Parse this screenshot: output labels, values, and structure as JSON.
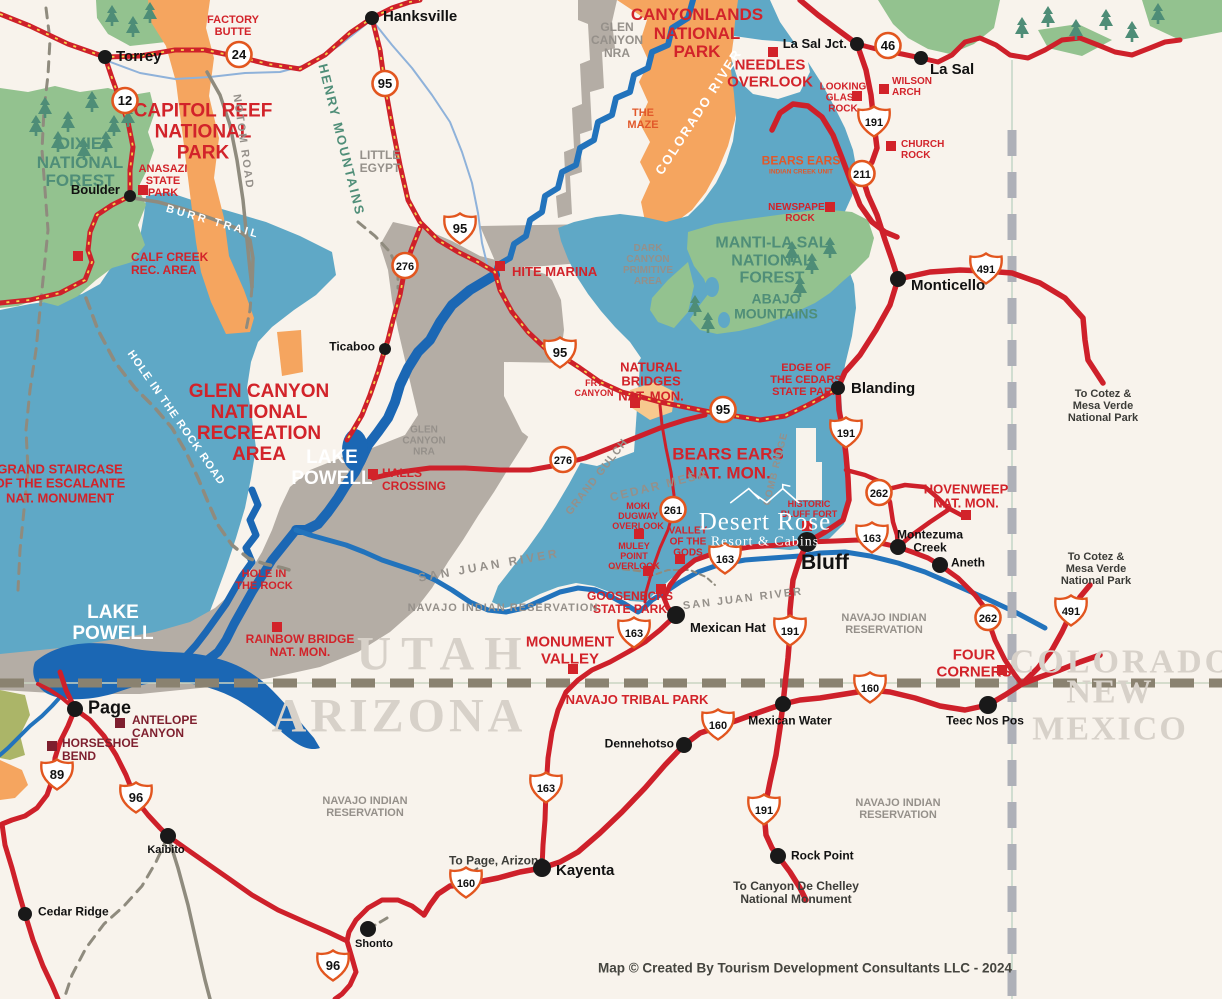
{
  "caption": "Map © Created By Tourism Development Consultants LLC - 2024",
  "desert_rose": {
    "name": "Desert Rose",
    "sub": "Resort & Cabins"
  },
  "colors": {
    "background": "#F8F3EC",
    "road_red": "#CE202A",
    "road_dash_yellow": "#F6D44C",
    "region_blue": "#5FA8C6",
    "region_gray": "#B4ADA5",
    "region_orange": "#F5A55F",
    "region_green": "#93C28F",
    "water_blue": "#1B67B4",
    "river_blue": "#2273BC",
    "label_red": "#D2232A",
    "label_dark_red": "#7E1F2E",
    "label_green": "#4F8E78",
    "label_gray": "#95908A",
    "state_name_gray": "#D7D1C9",
    "border_dash_tan": "#8A8270",
    "border_dash_gray": "#AEB0B8",
    "shield_border": "#E2561F"
  },
  "towns": [
    {
      "name": "Torrey",
      "dot": {
        "x": 105,
        "y": 57,
        "r": 7
      },
      "label": {
        "x": 116,
        "y": 57,
        "anchor": "l",
        "size": 15
      }
    },
    {
      "name": "Hanksville",
      "dot": {
        "x": 372,
        "y": 18,
        "r": 7
      },
      "label": {
        "x": 383,
        "y": 17,
        "anchor": "l",
        "size": 15
      }
    },
    {
      "name": "Boulder",
      "dot": {
        "x": 130,
        "y": 196,
        "r": 6
      },
      "label": {
        "x": 120,
        "y": 190,
        "anchor": "r",
        "size": 13
      }
    },
    {
      "name": "Ticaboo",
      "dot": {
        "x": 385,
        "y": 349,
        "r": 6
      },
      "label": {
        "x": 375,
        "y": 347,
        "anchor": "r",
        "size": 12
      }
    },
    {
      "name": "La Sal Jct.",
      "dot": {
        "x": 857,
        "y": 44,
        "r": 7
      },
      "label": {
        "x": 847,
        "y": 44,
        "anchor": "r",
        "size": 13
      }
    },
    {
      "name": "La Sal",
      "dot": {
        "x": 921,
        "y": 58,
        "r": 7
      },
      "label": {
        "x": 930,
        "y": 70,
        "anchor": "l",
        "size": 15
      }
    },
    {
      "name": "Monticello",
      "dot": {
        "x": 898,
        "y": 279,
        "r": 8
      },
      "label": {
        "x": 911,
        "y": 286,
        "anchor": "l",
        "size": 15
      }
    },
    {
      "name": "Blanding",
      "dot": {
        "x": 838,
        "y": 388,
        "r": 7
      },
      "label": {
        "x": 851,
        "y": 389,
        "anchor": "l",
        "size": 15
      }
    },
    {
      "name": "Bluff",
      "dot": {
        "x": 807,
        "y": 542,
        "r": 10
      },
      "label": {
        "x": 801,
        "y": 563,
        "anchor": "l",
        "size": 21
      }
    },
    {
      "name": "Mexican Hat",
      "dot": {
        "x": 676,
        "y": 615,
        "r": 9
      },
      "label": {
        "x": 690,
        "y": 628,
        "anchor": "l",
        "size": 13
      }
    },
    {
      "name": "Montezuma\nCreek",
      "dot": {
        "x": 898,
        "y": 547,
        "r": 8
      },
      "label": {
        "x": 930,
        "y": 541,
        "anchor": "c",
        "size": 12
      }
    },
    {
      "name": "Aneth",
      "dot": {
        "x": 940,
        "y": 565,
        "r": 8
      },
      "label": {
        "x": 951,
        "y": 563,
        "anchor": "l",
        "size": 12
      }
    },
    {
      "name": "Teec Nos Pos",
      "dot": {
        "x": 988,
        "y": 705,
        "r": 9
      },
      "label": {
        "x": 985,
        "y": 721,
        "anchor": "c",
        "size": 12
      }
    },
    {
      "name": "Mexican Water",
      "dot": {
        "x": 783,
        "y": 704,
        "r": 8
      },
      "label": {
        "x": 790,
        "y": 721,
        "anchor": "c",
        "size": 12
      }
    },
    {
      "name": "Dennehotso",
      "dot": {
        "x": 684,
        "y": 745,
        "r": 8
      },
      "label": {
        "x": 674,
        "y": 744,
        "anchor": "r",
        "size": 12
      }
    },
    {
      "name": "Rock Point",
      "dot": {
        "x": 778,
        "y": 856,
        "r": 8
      },
      "label": {
        "x": 791,
        "y": 856,
        "anchor": "l",
        "size": 12
      }
    },
    {
      "name": "Kayenta",
      "dot": {
        "x": 542,
        "y": 868,
        "r": 9
      },
      "label": {
        "x": 556,
        "y": 871,
        "anchor": "l",
        "size": 15
      }
    },
    {
      "name": "Shonto",
      "dot": {
        "x": 368,
        "y": 929,
        "r": 8
      },
      "label": {
        "x": 374,
        "y": 945,
        "anchor": "c",
        "size": 11
      }
    },
    {
      "name": "Kaibito",
      "dot": {
        "x": 168,
        "y": 836,
        "r": 8
      },
      "label": {
        "x": 166,
        "y": 851,
        "anchor": "c",
        "size": 11
      }
    },
    {
      "name": "Cedar Ridge",
      "dot": {
        "x": 25,
        "y": 914,
        "r": 7
      },
      "label": {
        "x": 38,
        "y": 912,
        "anchor": "l",
        "size": 12
      }
    },
    {
      "name": "Page",
      "dot": {
        "x": 75,
        "y": 709,
        "r": 8
      },
      "label": {
        "x": 88,
        "y": 708,
        "anchor": "l",
        "size": 18
      }
    }
  ],
  "poi_squares": [
    {
      "name": "anasazi-state-park",
      "x": 143,
      "y": 190,
      "color": "#D2232A"
    },
    {
      "name": "calf-creek",
      "x": 78,
      "y": 256,
      "color": "#D2232A"
    },
    {
      "name": "hite-marina",
      "x": 500,
      "y": 266,
      "color": "#D2232A"
    },
    {
      "name": "needles-overlook",
      "x": 773,
      "y": 52,
      "color": "#D2232A"
    },
    {
      "name": "wilson-arch",
      "x": 884,
      "y": 89,
      "color": "#D2232A"
    },
    {
      "name": "looking-glass-rock",
      "x": 857,
      "y": 96,
      "color": "#D2232A"
    },
    {
      "name": "church-rock",
      "x": 891,
      "y": 146,
      "color": "#D2232A"
    },
    {
      "name": "newspaper-rock",
      "x": 830,
      "y": 207,
      "color": "#D2232A"
    },
    {
      "name": "natural-bridges",
      "x": 635,
      "y": 403,
      "color": "#D2232A"
    },
    {
      "name": "hovenweep",
      "x": 966,
      "y": 515,
      "color": "#D2232A"
    },
    {
      "name": "halls-crossing",
      "x": 373,
      "y": 474,
      "color": "#D2232A"
    },
    {
      "name": "moki-dugway",
      "x": 639,
      "y": 534,
      "color": "#D2232A"
    },
    {
      "name": "muley-point",
      "x": 648,
      "y": 571,
      "color": "#D2232A"
    },
    {
      "name": "valley-of-the-gods",
      "x": 680,
      "y": 559,
      "color": "#D2232A"
    },
    {
      "name": "goosenecks",
      "x": 661,
      "y": 589,
      "color": "#D2232A"
    },
    {
      "name": "monument-valley",
      "x": 573,
      "y": 669,
      "color": "#D2232A"
    },
    {
      "name": "four-corners",
      "x": 1002,
      "y": 670,
      "color": "#D2232A"
    },
    {
      "name": "rainbow-bridge",
      "x": 277,
      "y": 627,
      "color": "#D2232A"
    },
    {
      "name": "historic-bluff-fort",
      "x": 807,
      "y": 526,
      "color": "#D2232A"
    },
    {
      "name": "antelope-canyon",
      "x": 120,
      "y": 723,
      "color": "#7E1F2E"
    },
    {
      "name": "horseshoe-bend",
      "x": 52,
      "y": 746,
      "color": "#7E1F2E"
    }
  ],
  "shields": [
    {
      "n": "24",
      "type": "circle",
      "x": 239,
      "y": 57
    },
    {
      "n": "12",
      "type": "circle",
      "x": 125,
      "y": 103
    },
    {
      "n": "95",
      "type": "circle",
      "x": 385,
      "y": 86
    },
    {
      "n": "95",
      "type": "shield",
      "x": 460,
      "y": 231
    },
    {
      "n": "276",
      "type": "circle",
      "x": 405,
      "y": 268
    },
    {
      "n": "95",
      "type": "shield",
      "x": 560,
      "y": 355
    },
    {
      "n": "95",
      "type": "circle",
      "x": 723,
      "y": 412
    },
    {
      "n": "276",
      "type": "circle",
      "x": 563,
      "y": 462
    },
    {
      "n": "261",
      "type": "circle",
      "x": 673,
      "y": 512
    },
    {
      "n": "46",
      "type": "circle",
      "x": 888,
      "y": 48
    },
    {
      "n": "191",
      "type": "shield",
      "x": 874,
      "y": 124
    },
    {
      "n": "211",
      "type": "circle",
      "x": 862,
      "y": 176
    },
    {
      "n": "491",
      "type": "shield",
      "x": 986,
      "y": 271
    },
    {
      "n": "191",
      "type": "shield",
      "x": 846,
      "y": 435
    },
    {
      "n": "262",
      "type": "circle",
      "x": 879,
      "y": 495
    },
    {
      "n": "163",
      "type": "shield",
      "x": 872,
      "y": 540
    },
    {
      "n": "163",
      "type": "shield",
      "x": 725,
      "y": 561
    },
    {
      "n": "163",
      "type": "shield",
      "x": 634,
      "y": 635
    },
    {
      "n": "191",
      "type": "shield",
      "x": 790,
      "y": 633
    },
    {
      "n": "262",
      "type": "circle",
      "x": 988,
      "y": 620
    },
    {
      "n": "491",
      "type": "shield",
      "x": 1071,
      "y": 613
    },
    {
      "n": "160",
      "type": "shield",
      "x": 870,
      "y": 690
    },
    {
      "n": "160",
      "type": "shield",
      "x": 718,
      "y": 727
    },
    {
      "n": "191",
      "type": "shield",
      "x": 764,
      "y": 812
    },
    {
      "n": "163",
      "type": "shield",
      "x": 546,
      "y": 790
    },
    {
      "n": "89",
      "type": "shield",
      "x": 57,
      "y": 777
    },
    {
      "n": "96",
      "type": "shield",
      "x": 136,
      "y": 800
    },
    {
      "n": "160",
      "type": "shield",
      "x": 466,
      "y": 885
    },
    {
      "n": "96",
      "type": "shield",
      "x": 333,
      "y": 968
    }
  ],
  "labels": [
    {
      "text": "FACTORY\nBUTTE",
      "x": 233,
      "y": 26,
      "cls": "red",
      "size": 11
    },
    {
      "text": "CAPITOL REEF\nNATIONAL\nPARK",
      "x": 203,
      "y": 133,
      "cls": "red",
      "size": 19
    },
    {
      "text": "CANYONLANDS\nNATIONAL\nPARK",
      "x": 697,
      "y": 34,
      "cls": "red",
      "size": 17
    },
    {
      "text": "NEEDLES\nOVERLOOK",
      "x": 770,
      "y": 74,
      "cls": "red",
      "size": 15
    },
    {
      "text": "ANASAZI\nSTATE\nPARK",
      "x": 163,
      "y": 181,
      "cls": "red",
      "size": 11
    },
    {
      "text": "CALF CREEK\nREC. AREA",
      "x": 131,
      "y": 264,
      "cls": "red",
      "size": 12,
      "anchor": "l",
      "lx": 88
    },
    {
      "text": "HITE MARINA",
      "x": 512,
      "y": 272,
      "cls": "red",
      "size": 13,
      "anchor": "l"
    },
    {
      "text": "GLEN CANYON\nNATIONAL\nRECREATION\nAREA",
      "x": 259,
      "y": 424,
      "cls": "red",
      "size": 19
    },
    {
      "text": "GRAND STAIRCASE\nOF THE ESCALANTE\nNAT. MONUMENT",
      "x": 60,
      "y": 484,
      "cls": "red",
      "size": 13
    },
    {
      "text": "NATURAL\nBRIDGES\nNAT. MON.",
      "x": 651,
      "y": 382,
      "cls": "red",
      "size": 13
    },
    {
      "text": "BEARS EARS\nNAT. MON.",
      "x": 728,
      "y": 464,
      "cls": "red",
      "size": 17
    },
    {
      "text": "EDGE OF\nTHE CEDARS\nSTATE PARK",
      "x": 806,
      "y": 380,
      "cls": "red",
      "size": 11
    },
    {
      "text": "HOVENWEEP\nNAT. MON.",
      "x": 966,
      "y": 497,
      "cls": "red",
      "size": 13
    },
    {
      "text": "HALLS\nCROSSING",
      "x": 382,
      "y": 480,
      "cls": "red",
      "size": 12,
      "anchor": "l"
    },
    {
      "text": "HOLE IN\nTHE ROCK",
      "x": 264,
      "y": 580,
      "cls": "red",
      "size": 11
    },
    {
      "text": "RAINBOW BRIDGE\nNAT. MON.",
      "x": 300,
      "y": 646,
      "cls": "red",
      "size": 12
    },
    {
      "text": "MONUMENT\nVALLEY",
      "x": 570,
      "y": 651,
      "cls": "red",
      "size": 15
    },
    {
      "text": "NAVAJO TRIBAL PARK",
      "x": 637,
      "y": 700,
      "cls": "red",
      "size": 13
    },
    {
      "text": "GOOSENECKS\nSTATE PARK",
      "x": 630,
      "y": 603,
      "cls": "red",
      "size": 12
    },
    {
      "text": "FOUR\nCORNERS",
      "x": 974,
      "y": 664,
      "cls": "red",
      "size": 15
    },
    {
      "text": "MOKI\nDUGWAY\nOVERLOOK",
      "x": 638,
      "y": 517,
      "cls": "red",
      "size": 9
    },
    {
      "text": "MULEY\nPOINT\nOVERLOOK",
      "x": 634,
      "y": 557,
      "cls": "red",
      "size": 9
    },
    {
      "text": "VALLEY\nOF THE\nGODS",
      "x": 688,
      "y": 542,
      "cls": "red",
      "size": 10
    },
    {
      "text": "FRY\nCANYON",
      "x": 594,
      "y": 389,
      "cls": "red",
      "size": 9
    },
    {
      "text": "WILSON\nARCH",
      "x": 892,
      "y": 87,
      "cls": "red",
      "size": 10,
      "anchor": "l"
    },
    {
      "text": "LOOKING\nGLASS\nROCK",
      "x": 843,
      "y": 98,
      "cls": "red",
      "size": 10
    },
    {
      "text": "CHURCH\nROCK",
      "x": 901,
      "y": 150,
      "cls": "red",
      "size": 10,
      "anchor": "l"
    },
    {
      "text": "NEWSPAPER\nROCK",
      "x": 800,
      "y": 213,
      "cls": "red",
      "size": 10
    },
    {
      "text": "BEARS EARS",
      "x": 801,
      "y": 161,
      "cls": "omz",
      "size": 12
    },
    {
      "text": "INDIAN CREEK UNIT",
      "x": 801,
      "y": 172,
      "cls": "omz",
      "size": 6.5
    },
    {
      "text": "HISTORIC\nBLUFF FORT",
      "x": 809,
      "y": 510,
      "cls": "red",
      "size": 9
    },
    {
      "text": "THE\nMAZE",
      "x": 643,
      "y": 119,
      "cls": "omz",
      "size": 11
    },
    {
      "text": "ANTELOPE\nCANYON",
      "x": 132,
      "y": 727,
      "cls": "dred",
      "size": 12,
      "anchor": "l"
    },
    {
      "text": "HORSESHOE\nBEND",
      "x": 62,
      "y": 750,
      "cls": "dred",
      "size": 12,
      "anchor": "l"
    },
    {
      "text": "DIXIE\nNATIONAL\nFOREST",
      "x": 80,
      "y": 163,
      "cls": "grn",
      "size": 17
    },
    {
      "text": "MANTI-LA SAL\nNATIONAL\nFOREST",
      "x": 772,
      "y": 261,
      "cls": "grn",
      "size": 16
    },
    {
      "text": "ABAJO\nMOUNTAINS",
      "x": 776,
      "y": 307,
      "cls": "grn",
      "size": 14
    },
    {
      "text": "HENRY MOUNTAINS",
      "x": 341,
      "y": 140,
      "cls": "grn",
      "size": 13,
      "rot": 76,
      "ls": 2
    },
    {
      "text": "GLEN\nCANYON\nNRA",
      "x": 617,
      "y": 41,
      "cls": "gry",
      "size": 12
    },
    {
      "text": "GLEN\nCANYON\nNRA",
      "x": 424,
      "y": 441,
      "cls": "gry",
      "size": 10
    },
    {
      "text": "LITTLE\nEGYPT",
      "x": 380,
      "y": 162,
      "cls": "gry",
      "size": 12
    },
    {
      "text": "DARK\nCANYON\nPRIMITIVE\nAREA",
      "x": 648,
      "y": 265,
      "cls": "gry",
      "size": 10
    },
    {
      "text": "NOTOM ROAD",
      "x": 243,
      "y": 142,
      "cls": "gry",
      "size": 11,
      "rot": 82,
      "ls": 2
    },
    {
      "text": "BURR TRAIL",
      "x": 213,
      "y": 222,
      "cls": "wht",
      "size": 11,
      "rot": 16,
      "ls": 3
    },
    {
      "text": "HOLE IN THE ROCK ROAD",
      "x": 176,
      "y": 418,
      "cls": "wht",
      "size": 11,
      "rot": 55,
      "ls": 1
    },
    {
      "text": "COLORADO RIVER",
      "x": 699,
      "y": 112,
      "cls": "wht",
      "size": 13,
      "rot": -57,
      "ls": 2
    },
    {
      "text": "GRAND GULCH",
      "x": 597,
      "y": 477,
      "cls": "gry",
      "size": 11,
      "rot": -52,
      "ls": 1
    },
    {
      "text": "CEDAR MESA",
      "x": 659,
      "y": 486,
      "cls": "gry",
      "size": 12,
      "rot": -14,
      "ls": 2
    },
    {
      "text": "COMB RIDGE",
      "x": 776,
      "y": 469,
      "cls": "gry",
      "size": 10,
      "rot": -76,
      "ls": 1
    },
    {
      "text": "SAN JUAN RIVER",
      "x": 489,
      "y": 566,
      "cls": "gry",
      "size": 12,
      "rot": -10,
      "ls": 3
    },
    {
      "text": "SAN JUAN RIVER",
      "x": 743,
      "y": 599,
      "cls": "gry",
      "size": 11,
      "rot": -7,
      "ls": 2
    },
    {
      "text": "NAVAJO INDIAN RESERVATION",
      "x": 503,
      "y": 608,
      "cls": "gry",
      "size": 11,
      "ls": 1
    },
    {
      "text": "NAVAJO INDIAN\nRESERVATION",
      "x": 884,
      "y": 624,
      "cls": "gry",
      "size": 11
    },
    {
      "text": "NAVAJO INDIAN\nRESERVATION",
      "x": 365,
      "y": 807,
      "cls": "gry",
      "size": 11
    },
    {
      "text": "NAVAJO INDIAN\nRESERVATION",
      "x": 898,
      "y": 809,
      "cls": "gry",
      "size": 11
    },
    {
      "text": "LAKE\nPOWELL",
      "x": 332,
      "y": 469,
      "cls": "wht",
      "size": 19
    },
    {
      "text": "LAKE\nPOWELL",
      "x": 113,
      "y": 624,
      "cls": "wht",
      "size": 19
    },
    {
      "text": "UTAH",
      "x": 444,
      "y": 655,
      "cls": "state",
      "size": 48,
      "ls": 10
    },
    {
      "text": "ARIZONA",
      "x": 399,
      "y": 717,
      "cls": "state",
      "size": 48,
      "ls": 4
    },
    {
      "text": "COLORADO",
      "x": 1122,
      "y": 662,
      "cls": "state",
      "size": 34,
      "ls": 3
    },
    {
      "text": "NEW MEXICO",
      "x": 1110,
      "y": 711,
      "cls": "state",
      "size": 34,
      "ls": 2
    },
    {
      "text": "To Cotez &\nMesa Verde\nNational Park",
      "x": 1103,
      "y": 406,
      "cls": "blk",
      "size": 11
    },
    {
      "text": "To Cotez &\nMesa Verde\nNational Park",
      "x": 1096,
      "y": 569,
      "cls": "blk",
      "size": 11
    },
    {
      "text": "To Canyon De Chelley\nNational Monument",
      "x": 796,
      "y": 893,
      "cls": "blk",
      "size": 12
    },
    {
      "text": "To Page, Arizona",
      "x": 497,
      "y": 861,
      "cls": "blk",
      "size": 12
    },
    {
      "text": "Map © Created By Tourism Development Consultants LLC - 2024",
      "x": 805,
      "y": 969,
      "cls": "cap",
      "size": 13.5
    }
  ]
}
